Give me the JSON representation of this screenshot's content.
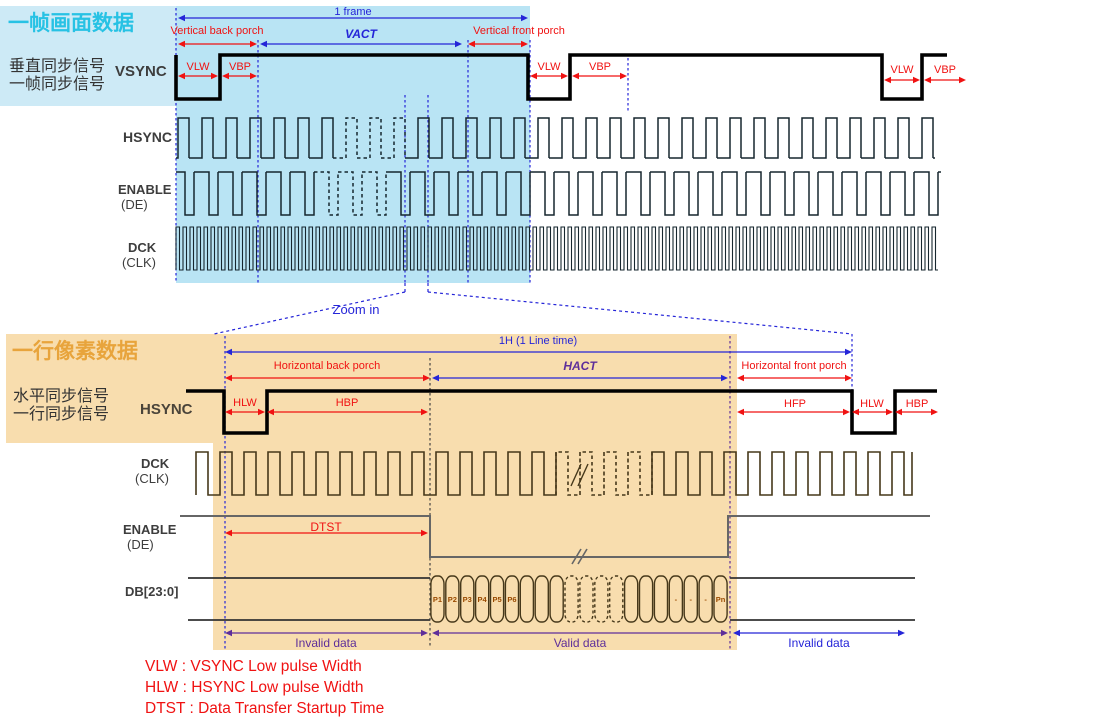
{
  "signals": {
    "vsync": "VSYNC",
    "hsync": "HSYNC",
    "enable": "ENABLE",
    "de": "(DE)",
    "dck": "DCK",
    "clk": "(CLK)",
    "db": "DB[23:0]"
  },
  "frame": {
    "title": "一帧画面数据",
    "side1": "垂直同步信号",
    "side2": "一帧同步信号",
    "one_frame": "1 frame",
    "vbp_long": "Vertical back porch",
    "vact": "VACT",
    "vfp_long": "Vertical front porch",
    "vlw": "VLW",
    "vbp": "VBP"
  },
  "zoom_in": "Zoom in",
  "line": {
    "title": "一行像素数据",
    "side1": "水平同步信号",
    "side2": "一行同步信号",
    "one_line": "1H (1 Line time)",
    "hbp_long": "Horizontal back porch",
    "hact": "HACT",
    "hfp_long": "Horizontal front porch",
    "hlw": "HLW",
    "hbp": "HBP",
    "hfp": "HFP",
    "dtst": "DTST",
    "invalid": "Invalid data",
    "valid": "Valid data",
    "db_cells": [
      "P1",
      "P2",
      "P3",
      "P4",
      "P5",
      "P6",
      "",
      "",
      "",
      "",
      "",
      "",
      "",
      "",
      "",
      "",
      "-",
      "-",
      "-",
      "Pn"
    ]
  },
  "legend": {
    "items": [
      "VLW : VSYNC Low pulse Width",
      "HLW : HSYNC Low pulse Width",
      "DTST : Data Transfer Startup Time"
    ]
  },
  "colors": {
    "frame_panel": "#cdeaf6",
    "frame_highlight": "#b9e4f4",
    "line_highlight": "#f8ddae",
    "frame_title": "#27c2e4",
    "line_title": "#e8a43c",
    "red": "#f01212",
    "blue": "#2525d8",
    "purple": "#5e2e9a",
    "ink": "#16262e",
    "ink_warm": "#46381a",
    "gray_line": "#666666"
  }
}
